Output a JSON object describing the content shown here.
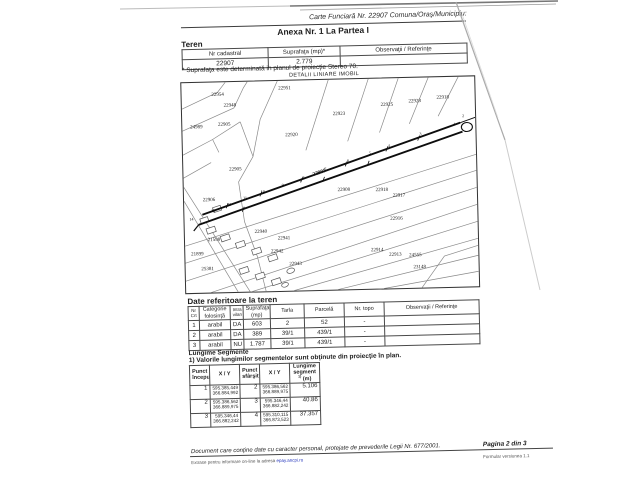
{
  "header": {
    "carte_funciara_note": "Carte Funciară Nr. 22907 Comuna/Oraş/Municipiu:",
    "anexa_title": "Anexa Nr. 1 La Partea I"
  },
  "teren": {
    "heading": "Teren",
    "table": {
      "headers": [
        "Nr cadastral",
        "Suprafaţa (mp)*",
        "Observaţii / Referinţe"
      ],
      "row": {
        "nr_cadastral": "22907",
        "suprafata": "2.779",
        "observatii": ""
      }
    },
    "footnote": "* Suprafaţa este determinată in planul de proiecţie Stereo 70."
  },
  "map": {
    "title": "DETALII LINIARE IMOBIL",
    "highlight_parcel": "22907",
    "labels": [
      {
        "text": "22951",
        "x": 103,
        "y": 8
      },
      {
        "text": "22954",
        "x": 36,
        "y": 13
      },
      {
        "text": "22948",
        "x": 48,
        "y": 24
      },
      {
        "text": "24989",
        "x": 14,
        "y": 45
      },
      {
        "text": "22905",
        "x": 42,
        "y": 43
      },
      {
        "text": "22923",
        "x": 157,
        "y": 35
      },
      {
        "text": "22925",
        "x": 205,
        "y": 27
      },
      {
        "text": "22928",
        "x": 233,
        "y": 24
      },
      {
        "text": "22918",
        "x": 261,
        "y": 21
      },
      {
        "text": "22920",
        "x": 109,
        "y": 55
      },
      {
        "text": "22905",
        "x": 52,
        "y": 88
      },
      {
        "text": "22907",
        "x": 136,
        "y": 93,
        "bold": true,
        "rot": -17
      },
      {
        "text": "22906",
        "x": 25,
        "y": 118
      },
      {
        "text": "22908",
        "x": 160,
        "y": 111
      },
      {
        "text": "22918",
        "x": 198,
        "y": 112
      },
      {
        "text": "22917",
        "x": 215,
        "y": 118
      },
      {
        "text": "22916",
        "x": 212,
        "y": 141
      },
      {
        "text": "22940",
        "x": 76,
        "y": 151
      },
      {
        "text": "22941",
        "x": 99,
        "y": 158
      },
      {
        "text": "22942",
        "x": 92,
        "y": 171
      },
      {
        "text": "22943",
        "x": 110,
        "y": 184
      },
      {
        "text": "22914",
        "x": 192,
        "y": 172
      },
      {
        "text": "22913",
        "x": 210,
        "y": 177
      },
      {
        "text": "24555",
        "x": 230,
        "y": 178
      },
      {
        "text": "23148",
        "x": 234,
        "y": 190
      },
      {
        "text": "21598",
        "x": 29,
        "y": 158
      },
      {
        "text": "21899",
        "x": 12,
        "y": 172
      },
      {
        "text": "25381",
        "x": 22,
        "y": 187
      }
    ],
    "points": [
      {
        "n": "2",
        "x": 281,
        "y": 39
      },
      {
        "n": "1",
        "x": 272,
        "y": 47
      },
      {
        "n": "3",
        "x": 238,
        "y": 56
      },
      {
        "n": "4",
        "x": 206,
        "y": 67
      },
      {
        "n": "5",
        "x": 187,
        "y": 74
      },
      {
        "n": "6",
        "x": 165,
        "y": 81
      },
      {
        "n": "7",
        "x": 142,
        "y": 89
      },
      {
        "n": "8",
        "x": 120,
        "y": 97
      },
      {
        "n": "9",
        "x": 99,
        "y": 104
      },
      {
        "n": "10",
        "x": 79,
        "y": 110
      },
      {
        "n": "11",
        "x": 61,
        "y": 116
      },
      {
        "n": "12",
        "x": 45,
        "y": 122
      },
      {
        "n": "13",
        "x": 29,
        "y": 128
      },
      {
        "n": "14",
        "x": 7,
        "y": 136
      }
    ]
  },
  "date_teren": {
    "heading": "Date referitoare la teren",
    "headers": {
      "nr": "Nr Crt",
      "categorie": "Categorie folosinţă",
      "intravilan": "Intra vilan",
      "suprafata": "Suprafaţa (mp)",
      "tarla": "Tarla",
      "parcela": "Parcelă",
      "nr_topo": "Nr. topo",
      "observatii": "Observaţii / Referinţe"
    },
    "rows": [
      {
        "nr": "1",
        "categorie": "arabil",
        "intravilan": "DA",
        "suprafata": "603",
        "tarla": "2",
        "parcela": "52",
        "nr_topo": "-",
        "observatii": ""
      },
      {
        "nr": "2",
        "categorie": "arabil",
        "intravilan": "DA",
        "suprafata": "389",
        "tarla": "39/1",
        "parcela": "439/1",
        "nr_topo": "-",
        "observatii": ""
      },
      {
        "nr": "3",
        "categorie": "arabil",
        "intravilan": "NU",
        "suprafata": "1.787",
        "tarla": "39/1",
        "parcela": "439/1",
        "nr_topo": "-",
        "observatii": ""
      }
    ]
  },
  "segmente": {
    "heading": "Lungime Segmente",
    "note": "1) Valorile lungimilor segmentelor sunt obţinute din proiecţie în plan.",
    "headers": {
      "p_start": "Punct început",
      "xy1": "X / Y",
      "p_end": "Punct sfârşit",
      "xy2": "X / Y",
      "len_label": "Lungime segment",
      "len_marker": "1)",
      "len_unit": "(m)"
    },
    "rows": [
      {
        "p1": "1",
        "x1": "595.385,449",
        "y1": "366.884,992",
        "p2": "2",
        "x2": "595.386,562",
        "y2": "366.889,975",
        "len": "5.106"
      },
      {
        "p1": "2",
        "x1": "595.386,562",
        "y1": "366.889,975",
        "p2": "3",
        "x2": "595.346,44",
        "y2": "366.882,242",
        "len": "40.86"
      },
      {
        "p1": "3",
        "x1": "595.346,44",
        "y1": "366.882,242",
        "p2": "4",
        "x2": "595.310,115",
        "y2": "366.873,523",
        "len": "37.357"
      }
    ]
  },
  "footer": {
    "privacy": "Document care conţine date cu caracter personal, protejate de prevederile Legii Nr. 677/2001.",
    "page_info": "Pagina 2 din 3",
    "extras_prefix": "Extrase pentru informare on-line la adresa ",
    "extras_link": "epay.ancpi.ro",
    "version": "Formular versiunea 1.1"
  }
}
